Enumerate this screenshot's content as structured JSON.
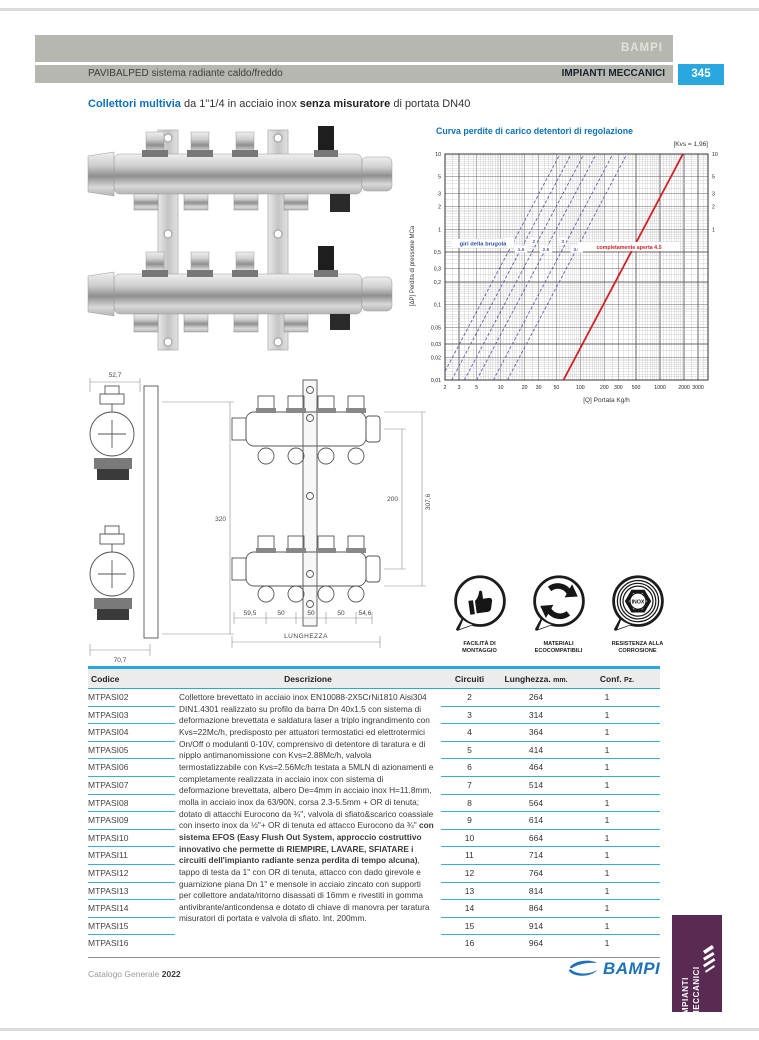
{
  "colors": {
    "accent_blue": "#29a8e0",
    "title_blue": "#0d71b8",
    "curve_red": "#d21f26",
    "curve_blue": "#5c60a8",
    "tab_purple": "#592b54",
    "band_gray": "#b7b7b1",
    "logo_blue": "#1e72b8"
  },
  "header": {
    "brand": "BAMPI",
    "left": "PAVIBALPED sistema radiante caldo/freddo",
    "right": "IMPIANTI MECCANICI",
    "page_number": "345"
  },
  "title": {
    "b1": "Collettori multivia",
    "t1": " da 1\"1/4 in acciaio inox ",
    "b2": "senza misuratore",
    "t2": " di portata DN40"
  },
  "chart_data": {
    "type": "line",
    "title": "Curva perdite di carico detentori di regolazione",
    "corner_label": "[Kvs = 1,96]",
    "xlabel": "[Q]  Portata Kg/h",
    "ylabel": "[ΔP]  Perdita di pressione MCa",
    "x_range": [
      2,
      4000
    ],
    "y_range": [
      0.01,
      10
    ],
    "x_ticks": [
      2,
      3,
      5,
      10,
      20,
      30,
      50,
      100,
      200,
      300,
      500,
      1000,
      2000,
      3000
    ],
    "y_ticks_left": {
      "values": [
        10,
        5,
        3,
        2,
        1,
        0.5,
        0.3,
        0.2,
        0.1,
        0.05,
        0.03,
        0.02,
        0.01
      ],
      "labels": [
        "10",
        "5",
        "3",
        "2",
        "1",
        "0,5",
        "0,3",
        "0,2",
        "0,1",
        "0,05",
        "0,03",
        "0,02",
        "0,01"
      ]
    },
    "y_ticks_right": {
      "values": [
        1000,
        500,
        300,
        200,
        100,
        50,
        30,
        20,
        10,
        5,
        3,
        2,
        1
      ],
      "labels": [
        "1000",
        "500",
        "300",
        "200",
        "100",
        "50",
        "30",
        "20",
        "10",
        "5",
        "3",
        "2",
        "1"
      ]
    },
    "grid": true,
    "curves_note": "giri della brugola",
    "mid_dp": 0.55,
    "setting_curves": [
      {
        "label": "1",
        "x_at_mid": 13
      },
      {
        "label": "1.5",
        "x_at_mid": 18
      },
      {
        "label": "2",
        "x_at_mid": 26
      },
      {
        "label": "2.5",
        "x_at_mid": 37
      },
      {
        "label": "3",
        "x_at_mid": 60
      },
      {
        "label": "3.5",
        "x_at_mid": 90
      }
    ],
    "open_curve": {
      "label": "completamente aperta 4.5",
      "kvs": 1.96,
      "x_at_mid": 455
    }
  },
  "drawing": {
    "top_width": "52,7",
    "height": "320",
    "bottom_width": "70,7",
    "pitch": [
      "59,5",
      "50",
      "50",
      "50",
      "54,6"
    ],
    "length_label": "LUNGHEZZA",
    "center_distance": "200",
    "total_height": "307,6"
  },
  "badges": [
    {
      "icon": "thumbs-up-icon",
      "line1": "FACILITÀ DI",
      "line2": "MONTAGGIO"
    },
    {
      "icon": "recycle-icon",
      "line1": "MATERIALI",
      "line2": "ECOCOMPATIBILI"
    },
    {
      "icon": "inox-icon",
      "line1": "RESISTENZA ALLA",
      "line2": "CORROSIONE",
      "center_text": "INOX"
    }
  ],
  "table": {
    "headers": [
      {
        "main": "Codice",
        "sub": ""
      },
      {
        "main": "Descrizione",
        "sub": ""
      },
      {
        "main": "Circuiti",
        "sub": ""
      },
      {
        "main": "Lunghezza.",
        "sub": "mm."
      },
      {
        "main": "Conf.",
        "sub": "Pz."
      }
    ],
    "description": {
      "part1": "Collettore brevettato in acciaio inox EN10088-2X5CrNi1810 Aisi304 DIN1.4301 realizzato su profilo da barra Dn 40x1.5 con sistema di deformazione brevettata e saldatura laser a triplo ingrandimento con Kvs=22Mc/h, predisposto per attuatori termostatici ed elettrotermici On/Off o modulanti 0-10V, comprensivo di detentore di taratura e di nipplo antimanomissione con Kvs=2.88Mc/h, valvola termostatizzabile con Kvs=2.56Mc/h testata a 5MLN di azionamenti e completamente realizzata in acciaio inox con sistema di deformazione brevettata, albero De=4mm in acciaio inox H=11.8mm, molla in acciaio inox da 63/90N, corsa 2.3-5.5mm + OR di tenuta; dotato di attacchi Eurocono da ¾\", valvola di sfiato&scarico coassiale con inserto inox da ½\"+ OR di tenuta ed attacco Eurocono da ¾\" ",
      "bold": "con sistema EFOS (Easy Flush Out System, approccio costruttivo innovativo che permette di RIEMPIRE, LAVARE, SFIATARE i circuiti dell'impianto radiante senza perdita di tempo alcuna)",
      "part2": ", tappo di testa da 1\" con OR di tenuta, attacco con dado girevole e guarnizione piana Dn 1\" e mensole in acciaio zincato con supporti per collettore andata/ritorno disassati di 16mm e rivestiti in gomma antivibrante/anticondensa e dotato di chiave di manovra per taratura misuratori di portata e valvola di sfiato. Int. 200mm."
    },
    "rows": [
      {
        "code": "MTPASI02",
        "circuiti": "2",
        "lunghezza": "264",
        "conf": "1"
      },
      {
        "code": "MTPASI03",
        "circuiti": "3",
        "lunghezza": "314",
        "conf": "1"
      },
      {
        "code": "MTPASI04",
        "circuiti": "4",
        "lunghezza": "364",
        "conf": "1"
      },
      {
        "code": "MTPASI05",
        "circuiti": "5",
        "lunghezza": "414",
        "conf": "1"
      },
      {
        "code": "MTPASI06",
        "circuiti": "6",
        "lunghezza": "464",
        "conf": "1"
      },
      {
        "code": "MTPASI07",
        "circuiti": "7",
        "lunghezza": "514",
        "conf": "1"
      },
      {
        "code": "MTPASI08",
        "circuiti": "8",
        "lunghezza": "564",
        "conf": "1"
      },
      {
        "code": "MTPASI09",
        "circuiti": "9",
        "lunghezza": "614",
        "conf": "1"
      },
      {
        "code": "MTPASI10",
        "circuiti": "10",
        "lunghezza": "664",
        "conf": "1"
      },
      {
        "code": "MTPASI11",
        "circuiti": "11",
        "lunghezza": "714",
        "conf": "1"
      },
      {
        "code": "MTPASI12",
        "circuiti": "12",
        "lunghezza": "764",
        "conf": "1"
      },
      {
        "code": "MTPASI13",
        "circuiti": "13",
        "lunghezza": "814",
        "conf": "1"
      },
      {
        "code": "MTPASI14",
        "circuiti": "14",
        "lunghezza": "864",
        "conf": "1"
      },
      {
        "code": "MTPASI15",
        "circuiti": "15",
        "lunghezza": "914",
        "conf": "1"
      },
      {
        "code": "MTPASI16",
        "circuiti": "16",
        "lunghezza": "964",
        "conf": "1"
      }
    ]
  },
  "footer": {
    "catalog": "Catalogo Generale",
    "year": "2022",
    "logo": "BAMPI"
  },
  "side_tab": {
    "line1": "IMPIANTI",
    "line2": "MECCANICI"
  }
}
